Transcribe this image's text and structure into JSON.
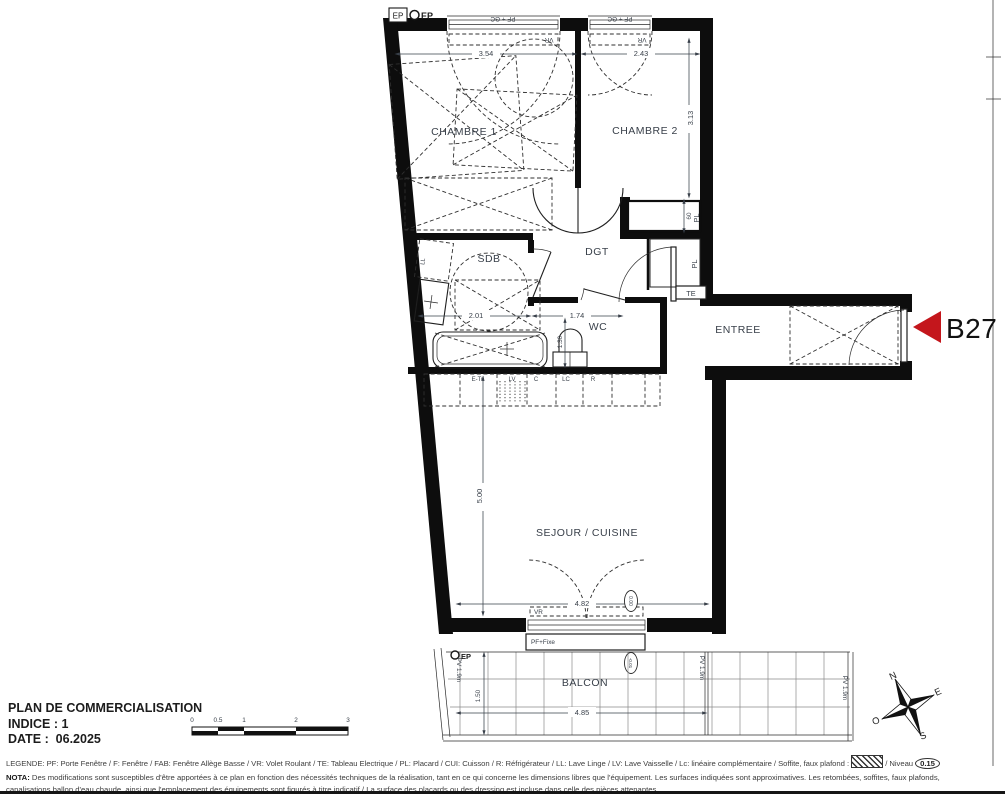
{
  "unit": {
    "label": "B27",
    "arrow_color": "#c4161c"
  },
  "rooms": {
    "chambre1": "CHAMBRE 1",
    "chambre2": "CHAMBRE 2",
    "sdb": "SDB",
    "dgt": "DGT",
    "wc": "WC",
    "entree": "ENTREE",
    "sejour": "SEJOUR / CUISINE",
    "balcon": "BALCON"
  },
  "dims": {
    "ch1_w": "3.54",
    "ch2_w": "2.43",
    "ch2_h": "3.13",
    "pl": "60",
    "sdb_w": "2.01",
    "wc_w": "1.74",
    "wc_d": "1.30",
    "sej_h": "5.00",
    "sej_w": "4.82",
    "bal_w": "4.85",
    "bal_d": "1.50"
  },
  "levels": {
    "sejour": "0.00",
    "balcon": "-0.01",
    "legend_niveau": "0.15"
  },
  "tags": {
    "ep": "EP",
    "te": "TE",
    "pl": "PL",
    "ll": "LL",
    "vr": "VR",
    "pf_gc": "PF + GC",
    "pf_fixe": "PF+Fixe",
    "pv": "PV 1.9m"
  },
  "kitchen": [
    "E-Tri",
    "LV",
    "C",
    "LC",
    "R"
  ],
  "compass": {
    "n": "N",
    "e": "E",
    "s": "S",
    "o": "O"
  },
  "titleblock": {
    "title": "PLAN DE COMMERCIALISATION",
    "indice": "INDICE : 1",
    "date": "DATE :  06.2025"
  },
  "scalebar": [
    "0",
    "0.5",
    "1",
    "2",
    "3"
  ],
  "legend": {
    "part1": "LEGENDE: PF: Porte Fenêtre / F: Fenêtre / FAB: Fenêtre Allège Basse / VR: Volet Roulant / TE: Tableau Electrique / PL: Placard / CUI: Cuisson / R: Réfrigérateur / LL: Lave Linge / LV: Lave Vaisselle / Lc: linéaire complémentaire / Soffite, faux plafond :",
    "part2": "/ Niveau"
  },
  "nota": {
    "label": "NOTA:",
    "text": " Des modifications sont susceptibles d'être apportées à ce plan en fonction des nécessités techniques de la réalisation, tant en ce qui concerne les dimensions libres que l'équipement. Les surfaces indiquées sont approximatives. Les retombées, soffites, faux plafonds, canalisations,ballon d'eau chaude, ainsi que l'emplacement des équipements sont figurés à titre indicatif / La surface des placards ou des dressing est incluse dans celle des pièces attenantes"
  }
}
